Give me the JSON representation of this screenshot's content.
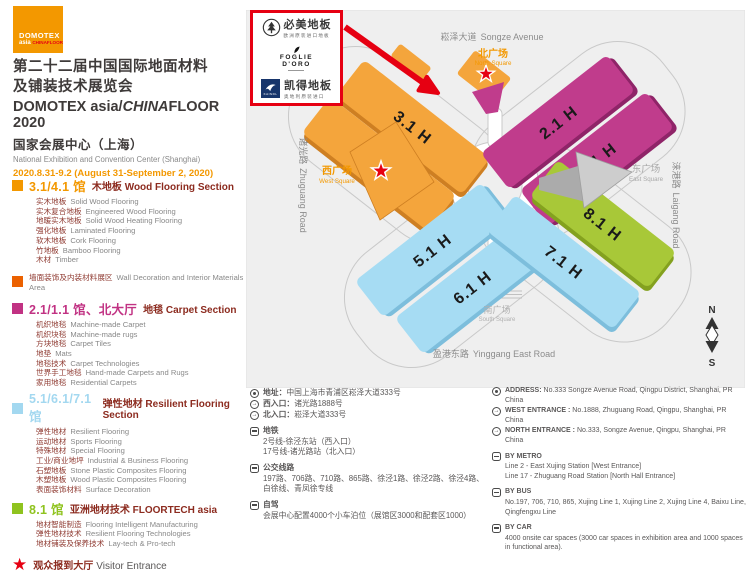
{
  "brand": {
    "logo_line1": "DOMOTEX",
    "logo_line2": "asia",
    "logo_line3": "CHINAFLOOR",
    "title_zh1": "第二十二届中国国际地面材料",
    "title_zh2": "及铺装技术展览会",
    "title_en_a": "DOMOTEX asia/",
    "title_en_b": "CHINA",
    "title_en_c": "FLOOR 2020",
    "venue_zh": "国家会展中心（上海）",
    "venue_en": "National Exhibition and Convention Center (Shanghai)",
    "dates": "2020.8.31-9.2  (August 31-September 2, 2020)",
    "accent_orange": "#F39800",
    "accent_red": "#E60012"
  },
  "legend": {
    "sections": [
      {
        "color": "#F39800",
        "hall": "3.1/4.1 馆",
        "category_zh": "木地板",
        "category_en": "Wood Flooring Section",
        "items": [
          {
            "zh": "实木地板",
            "en": "Solid Wood Flooring"
          },
          {
            "zh": "实木复合地板",
            "en": "Engineered Wood Flooring"
          },
          {
            "zh": "地暖实木地板",
            "en": "Solid Wood Heating Flooring"
          },
          {
            "zh": "强化地板",
            "en": "Laminated Flooring"
          },
          {
            "zh": "软木地板",
            "en": "Cork Flooring"
          },
          {
            "zh": "竹地板",
            "en": "Bamboo Flooring"
          },
          {
            "zh": "木材",
            "en": "Timber"
          }
        ]
      },
      {
        "color": "#EB6100",
        "note_zh": "墙面装饰及内装材料展区",
        "note_en": "Wall Decoration and Interior Materials Area"
      },
      {
        "color": "#C13283",
        "hall": "2.1/1.1 馆、北大厅",
        "category_zh": "地毯",
        "category_en": "Carpet Section",
        "items": [
          {
            "zh": "机织地毯",
            "en": "Machine-made Carpet"
          },
          {
            "zh": "机织块毯",
            "en": "Machine-made rugs"
          },
          {
            "zh": "方块地毯",
            "en": "Carpet Tiles"
          },
          {
            "zh": "地垫",
            "en": "Mats"
          },
          {
            "zh": "地毯技术",
            "en": "Carpet Technologies"
          },
          {
            "zh": "世界手工地毯",
            "en": "Hand-made Carpets and Rugs"
          },
          {
            "zh": "家用地毯",
            "en": "Residential Carpets"
          }
        ]
      },
      {
        "color": "#A3D8F0",
        "hall": "5.1/6.1/7.1 馆",
        "category_zh": "弹性地材",
        "category_en": "Resilient Flooring Section",
        "items": [
          {
            "zh": "弹性地材",
            "en": "Resilient Flooring"
          },
          {
            "zh": "运动地材",
            "en": "Sports Flooring"
          },
          {
            "zh": "特殊地材",
            "en": "Special Flooring"
          },
          {
            "zh": "工业/商业地坪",
            "en": "Industrial & Business Flooring"
          },
          {
            "zh": "石塑地板",
            "en": "Stone Plastic Composites Flooring"
          },
          {
            "zh": "木塑地板",
            "en": "Wood Plastic Composites Flooring"
          },
          {
            "zh": "表面装饰材料",
            "en": "Surface Decoration"
          }
        ]
      },
      {
        "color": "#8FC31F",
        "hall": "8.1 馆",
        "category_zh": "亚洲地材技术",
        "category_en": "FLOORTECH asia",
        "items": [
          {
            "zh": "地材智能制造",
            "en": "Flooring Intelligent Manufacturing"
          },
          {
            "zh": "弹性地材技术",
            "en": "Resilient Flooring Technologies"
          },
          {
            "zh": "地材铺装及保养技术",
            "en": "Lay-tech & Pro-tech"
          }
        ]
      }
    ],
    "visitor_entrance": {
      "star": "★",
      "zh": "观众报到大厅",
      "en": "Visitor Entrance",
      "star_color": "#E60012"
    }
  },
  "exhibitor_box": {
    "brand1_name": "必美地板",
    "brand1_sub": "欧洲原装进口地板",
    "brand2_line1": "FOGLIE",
    "brand2_line2": "D'ORO",
    "brand3_logo": "KAINDL",
    "brand3_name": "凯得地板",
    "brand3_sub": "奥地利原装进口"
  },
  "map": {
    "background": "#EFEFEF",
    "halls": [
      {
        "label": "3.1 H",
        "color": "#F4A53C",
        "shadow": "#CE7F22"
      },
      {
        "label": "4.1 H",
        "color": "#F4A53C",
        "shadow": "#CE7F22"
      },
      {
        "label": "2.1 H",
        "color": "#C03C8C",
        "shadow": "#8F2468"
      },
      {
        "label": "1.1 H",
        "color": "#C03C8C",
        "shadow": "#8F2468"
      },
      {
        "label": "5.1 H",
        "color": "#A6DCF3",
        "shadow": "#7DBEDC"
      },
      {
        "label": "6.1 H",
        "color": "#A6DCF3",
        "shadow": "#7DBEDC"
      },
      {
        "label": "7.1 H",
        "color": "#A6DCF3",
        "shadow": "#7DBEDC"
      },
      {
        "label": "8.1 H",
        "color": "#A8C838",
        "shadow": "#84A11F"
      }
    ],
    "roads": {
      "top": {
        "zh": "崧泽大道",
        "en": "Songze Avenue"
      },
      "right": {
        "zh": "涞港路",
        "en": "Laigang Road"
      },
      "bottom": {
        "zh": "盈港东路",
        "en": "Yinggang East Road"
      },
      "left": {
        "zh": "诸光路",
        "en": "Zhuguang Road"
      }
    },
    "squares": {
      "north": {
        "zh": "北广场",
        "en": "North Square",
        "color": "#F39800"
      },
      "west": {
        "zh": "西广场",
        "en": "West Square",
        "color": "#F39800"
      },
      "east": {
        "zh": "东广场",
        "en": "East Square",
        "color": "#A8A8A8"
      },
      "south": {
        "zh": "南广场",
        "en": "South Square",
        "color": "#B0B0B0"
      }
    },
    "compass": {
      "north": "N",
      "south": "S"
    }
  },
  "info_cn": {
    "address_label": "地址：",
    "address": "中国上海市青浦区崧泽大道333号",
    "west_label": "西入口：",
    "west": "诸光路1888号",
    "north_label": "北入口：",
    "north": "崧泽大道333号",
    "metro_title": "地铁",
    "metro_lines": [
      "2号线-徐泾东站（西入口）",
      "17号线-诸光路站（北入口）"
    ],
    "bus_title": "公交线路",
    "bus": "197路、706路、710路、865路、徐泾1路、徐泾2路、徐泾4路、白徐线、青凤徐专线",
    "drive_title": "自驾",
    "drive": "会展中心配置4000个小车泊位（展馆区3000和配套区1000）"
  },
  "info_en": {
    "address_label": "ADDRESS:",
    "address": "No.333 Songze Avenue Road, Qingpu District, Shanghai, PR China",
    "west_label": "WEST ENTRANCE :",
    "west": "No.1888, Zhuguang Road, Qingpu, Shanghai, PR China",
    "north_label": "NORTH ENTRANCE :",
    "north": "No.333, Songze Avenue, Qingpu, Shanghai, PR China",
    "metro_title": "BY METRO",
    "metro_lines": [
      "Line 2 - East Xujing Station [West Entrance]",
      "Line 17 - Zhuguang Road Station  [North Hall Entrance]"
    ],
    "bus_title": "BY BUS",
    "bus": "No.197, 706, 710, 865, Xujing Line 1, Xujing Line 2, Xujing Line 4, Baixu Line, Qingfengxu Line",
    "car_title": "BY CAR",
    "car": "4000 onsite car spaces (3000 car spaces in exhibition area and 1000 spaces in functional area)."
  }
}
